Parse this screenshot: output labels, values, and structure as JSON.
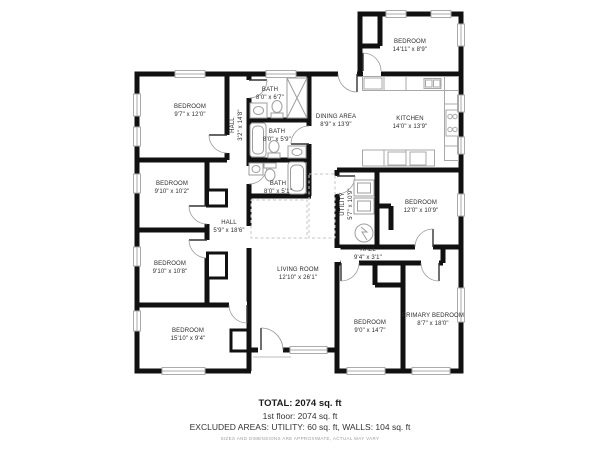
{
  "plan": {
    "rooms": [
      {
        "id": "bedroom-top-right",
        "name": "BEDROOM",
        "dims": "14'11\" x 8'9\""
      },
      {
        "id": "bedroom-upper-left",
        "name": "BEDROOM",
        "dims": "9'7\" x 12'0\""
      },
      {
        "id": "hall-upper",
        "name": "HALL",
        "dims": "3'2\" x 14'8\""
      },
      {
        "id": "bath-1",
        "name": "BATH",
        "dims": "8'0\" x 6'7\""
      },
      {
        "id": "bath-2",
        "name": "BATH",
        "dims": "8'0\" x 5'9\""
      },
      {
        "id": "dining-area",
        "name": "DINING AREA",
        "dims": "8'9\" x 13'9\""
      },
      {
        "id": "kitchen",
        "name": "KITCHEN",
        "dims": "14'0\" x 13'9\""
      },
      {
        "id": "bedroom-mid-left",
        "name": "BEDROOM",
        "dims": "9'10\" x 10'2\""
      },
      {
        "id": "bath-3",
        "name": "BATH",
        "dims": "8'0\" x 5'1\""
      },
      {
        "id": "utility",
        "name": "UTILITY",
        "dims": "5'7\" x 10'9\""
      },
      {
        "id": "bedroom-right",
        "name": "BEDROOM",
        "dims": "12'0\" x 10'9\""
      },
      {
        "id": "hall-center",
        "name": "HALL",
        "dims": "5'9\" x 18'6\""
      },
      {
        "id": "hall-right",
        "name": "HALL",
        "dims": "9'4\" x 3'1\""
      },
      {
        "id": "bedroom-lower-left",
        "name": "BEDROOM",
        "dims": "9'10\" x 10'8\""
      },
      {
        "id": "living-room",
        "name": "LIVING ROOM",
        "dims": "12'10\" x 26'1\""
      },
      {
        "id": "bedroom-bottom-left",
        "name": "BEDROOM",
        "dims": "15'10\" x 9'4\""
      },
      {
        "id": "bedroom-bottom-right",
        "name": "BEDROOM",
        "dims": "9'0\" x 14'7\""
      },
      {
        "id": "primary-bedroom",
        "name": "PRIMARY BEDROOM",
        "dims": "8'7\" x 18'0\""
      }
    ],
    "summary": {
      "total": "TOTAL: 2074 sq. ft",
      "floor1": "1st floor: 2074 sq. ft",
      "excluded": "EXCLUDED AREAS: UTILITY: 60 sq. ft, WALLS: 104 sq. ft",
      "disclaimer": "SIZES AND DIMENSIONS ARE APPROXIMATE, ACTUAL MAY VARY"
    },
    "colors": {
      "wall": "#111111",
      "fixture": "#9e9e9e",
      "window": "#ababab",
      "background": "#ffffff"
    }
  }
}
